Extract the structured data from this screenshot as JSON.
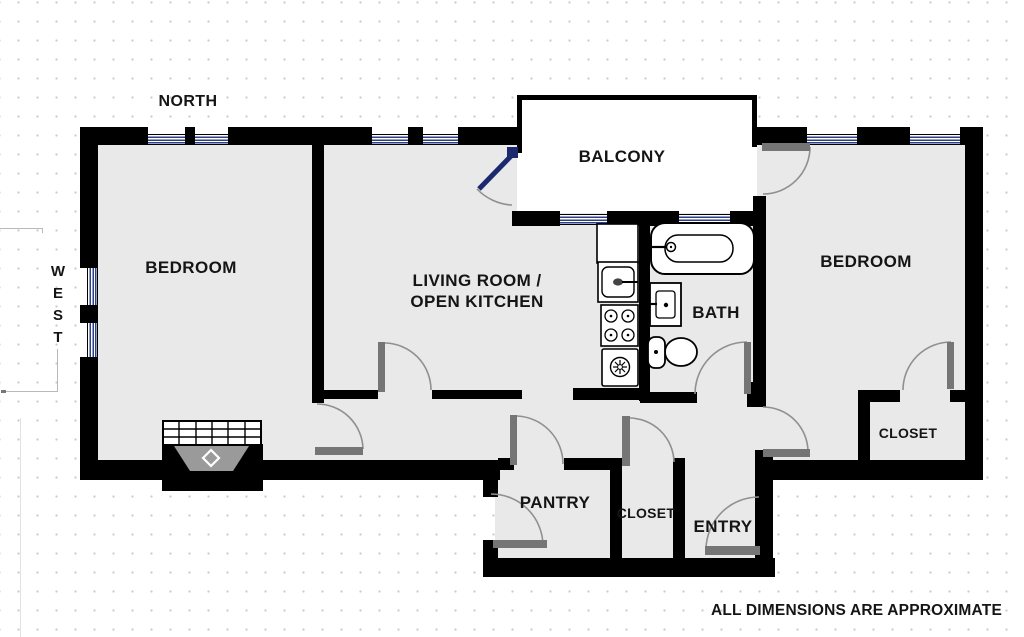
{
  "document": {
    "type": "apartment-floor-plan",
    "footer_note": "ALL DIMENSIONS ARE APPROXIMATE"
  },
  "compass": {
    "north": "NORTH",
    "west": "WEST"
  },
  "rooms": {
    "bedroom_left": {
      "label": "BEDROOM"
    },
    "living_kitchen": {
      "label_line1": "LIVING ROOM /",
      "label_line2": "OPEN KITCHEN"
    },
    "balcony": {
      "label": "BALCONY"
    },
    "bath": {
      "label": "BATH"
    },
    "bedroom_right": {
      "label": "BEDROOM"
    },
    "closet_right": {
      "label": "CLOSET"
    },
    "pantry": {
      "label": "PANTRY"
    },
    "closet_hall": {
      "label": "CLOSET"
    },
    "entry": {
      "label": "ENTRY"
    }
  },
  "fixtures": [
    "bathtub",
    "bathroom-sink",
    "toilet",
    "kitchen-counter",
    "kitchen-sink",
    "stove",
    "dishwasher",
    "fireplace",
    "balcony-glass-door"
  ],
  "colors": {
    "wall": "#000000",
    "floor": "#e9e9e9",
    "window_blue": "#2c3e85",
    "door_leaf_gray": "#757575",
    "balcony_door_blue": "#1b2a6e",
    "arc_gray": "#909090",
    "dot_grid": "#c7c7cd"
  }
}
